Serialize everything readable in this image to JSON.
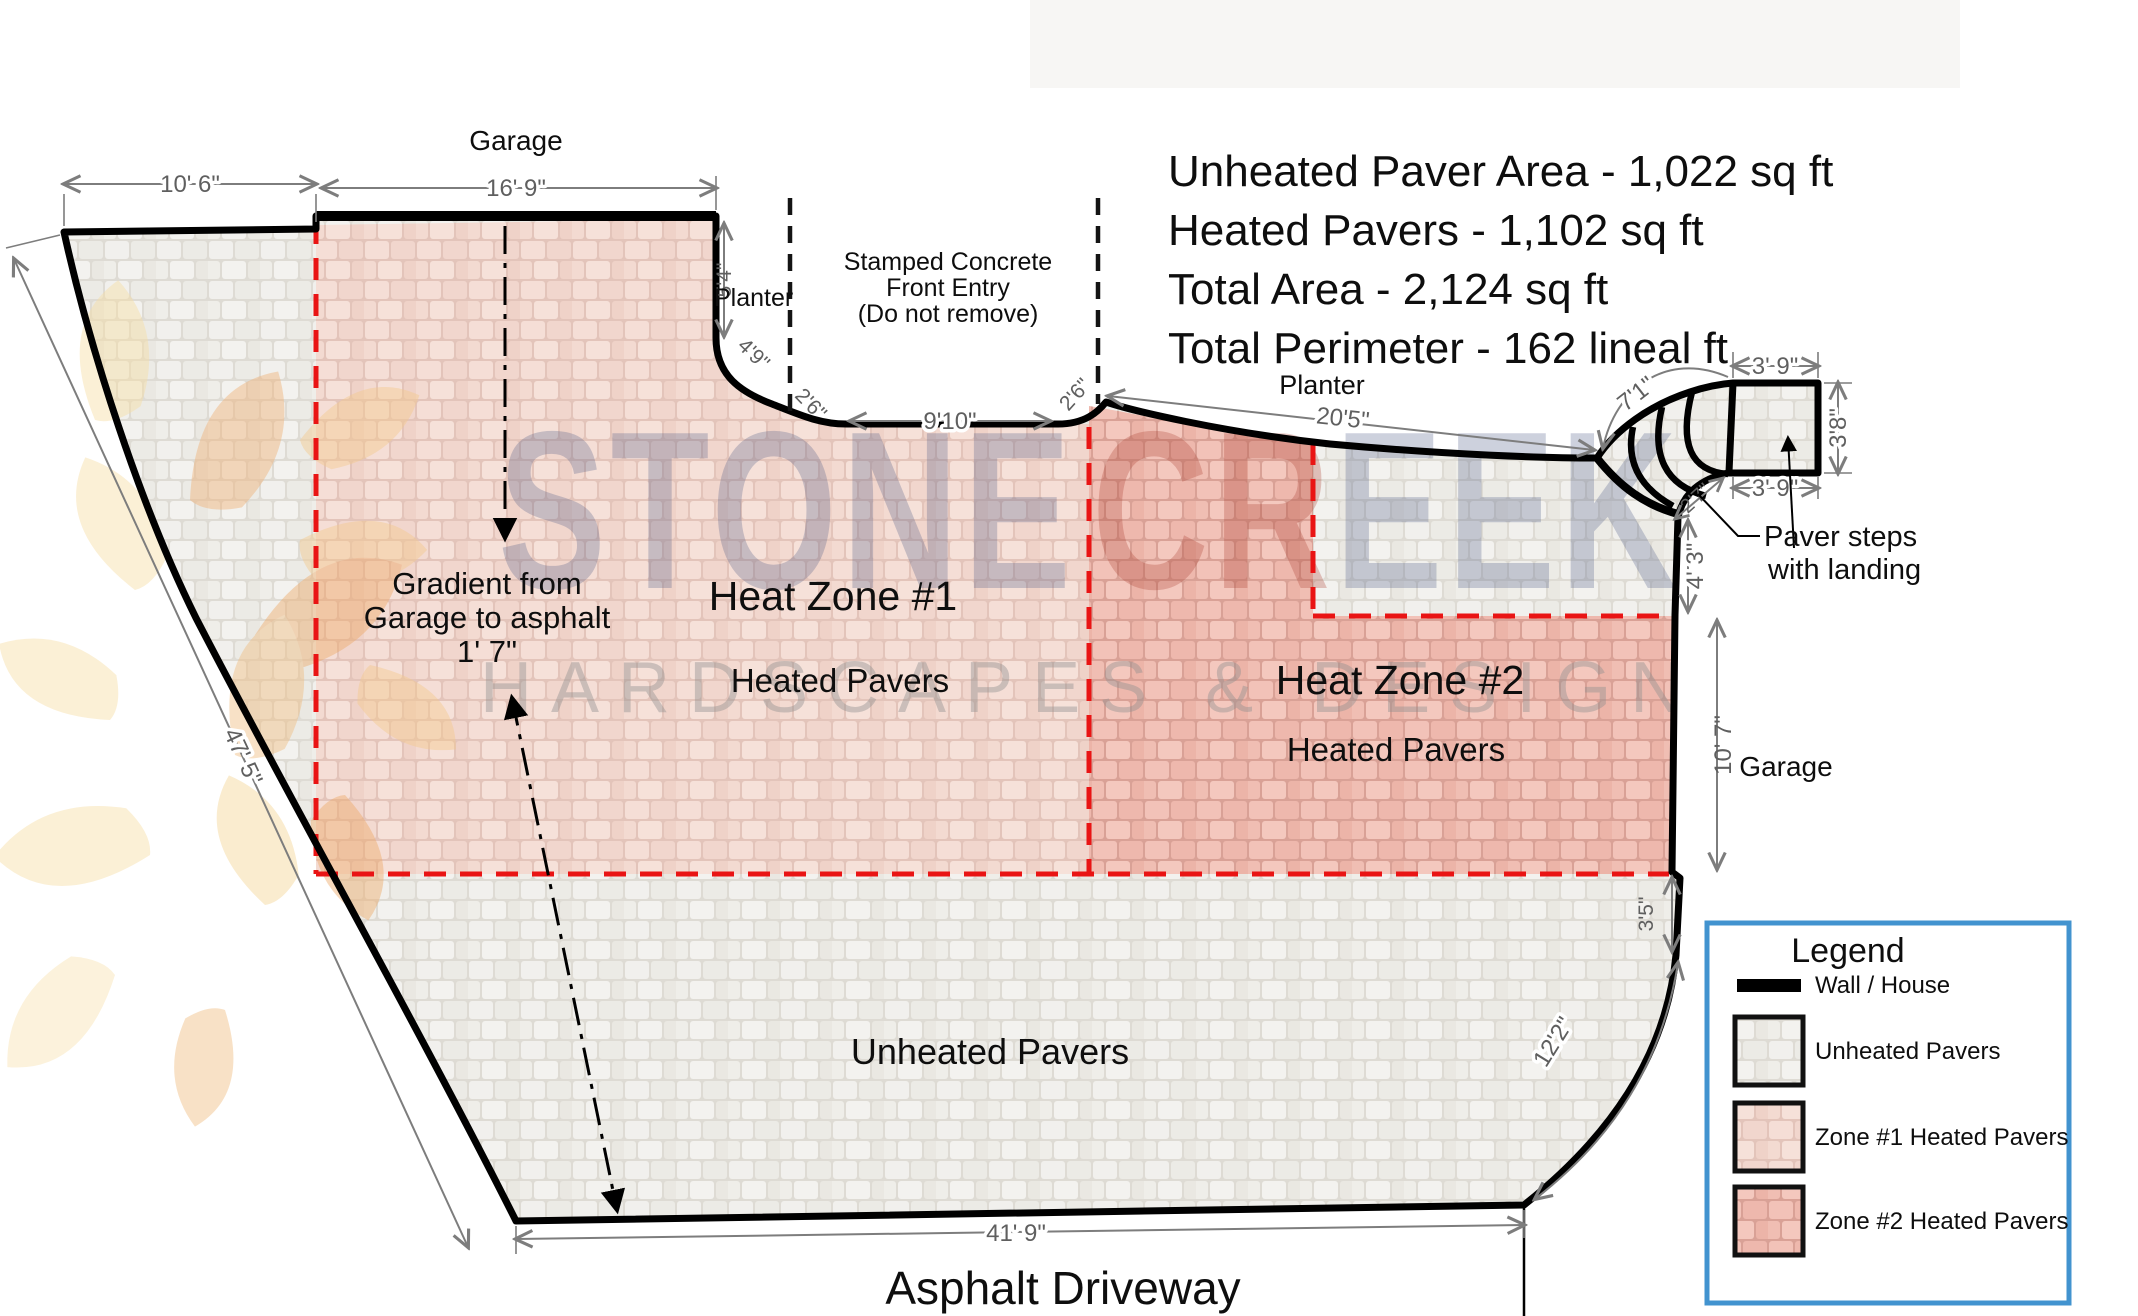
{
  "summary": {
    "lines": [
      "Unheated Paver Area - 1,022 sq ft",
      "Heated Pavers - 1,102 sq ft",
      "Total Area - 2,124 sq ft",
      "Total Perimeter - 162 lineal ft"
    ]
  },
  "plan": {
    "labels": {
      "garage_top": "Garage",
      "planter_left": "Planter",
      "entry_line1": "Stamped Concrete",
      "entry_line2": "Front Entry",
      "entry_line3": "(Do not remove)",
      "planter_right": "Planter",
      "steps_line1": "Paver steps",
      "steps_line2": "with landing",
      "zone1_title": "Heat Zone #1",
      "zone1_sub": "Heated Pavers",
      "zone2_title": "Heat Zone #2",
      "zone2_sub": "Heated Pavers",
      "garage_right": "Garage",
      "unheated": "Unheated Pavers",
      "asphalt": "Asphalt Driveway",
      "gradient_line1": "Gradient from",
      "gradient_line2": "Garage to asphalt",
      "gradient_line3": "1' 7\""
    },
    "dimensions": {
      "top_left": "10' 6\"",
      "garage_width": "16' 9\"",
      "planter_height": "5'4\"",
      "planter_curve": "4'9\"",
      "entry_left_curve": "2'6\"",
      "entry_width": "9'10\"",
      "entry_right_curve": "2'6\"",
      "planter_right_width": "20'5\"",
      "steps_diagonal": "7'1\"",
      "landing_top": "3' 9\"",
      "landing_side": "3'8\"",
      "landing_bottom": "3' 9\"",
      "steps_corner": "2'7\"",
      "wall_4_3": "4' 3\"",
      "garage_side": "10' 7\"",
      "wall_3_5": "3'5\"",
      "curve_right": "12'2\"",
      "bottom": "41' 9\"",
      "left_side": "47' 5\""
    }
  },
  "legend": {
    "title": "Legend",
    "items": [
      {
        "label": "Wall / House"
      },
      {
        "label": "Unheated Pavers"
      },
      {
        "label": "Zone #1 Heated Pavers"
      },
      {
        "label": "Zone #2 Heated Pavers"
      }
    ]
  },
  "watermark": {
    "brand_part1": "STONE",
    "brand_part2": "CR",
    "brand_part3": "EEK",
    "tagline": "HARDSCAPES & DESIGN"
  },
  "colors": {
    "unheated_paver": "#efeee9",
    "zone1_paver": "#f3dad1",
    "zone2_paver": "#f0beb3",
    "heat_zone_boundary": "#e91414",
    "legend_border": "#4293cf",
    "wall": "#000000"
  }
}
